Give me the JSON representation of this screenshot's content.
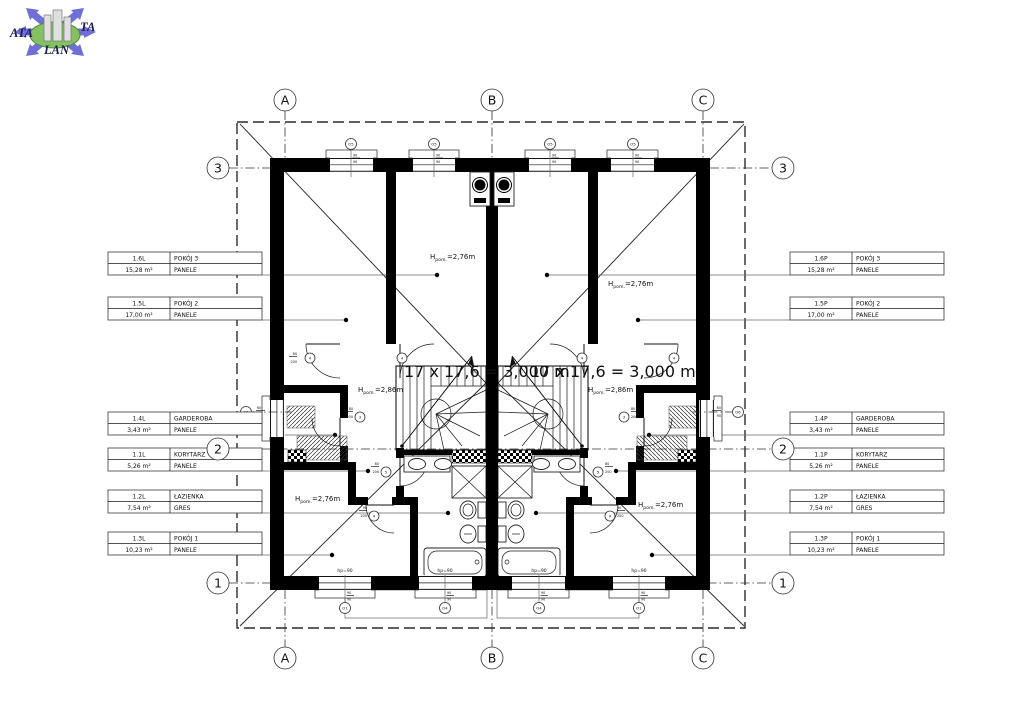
{
  "logo": {
    "ata": "ATA",
    "ta": "TA",
    "lan": "LAN"
  },
  "grid": {
    "cols": [
      "A",
      "B",
      "C"
    ],
    "rows": [
      "3",
      "2",
      "1"
    ]
  },
  "rooms_left": [
    {
      "id": "1.6L",
      "name": "POKÓJ 3",
      "area": "15,28 m²",
      "finish": "PANELE"
    },
    {
      "id": "1.5L",
      "name": "POKÓJ 2",
      "area": "17,00 m²",
      "finish": "PANELE"
    },
    {
      "id": "1.4L",
      "name": "GARDEROBA",
      "area": "3,43 m²",
      "finish": "PANELE"
    },
    {
      "id": "1.1L",
      "name": "KORYTARZ",
      "area": "5,26 m²",
      "finish": "PANELE"
    },
    {
      "id": "1.2L",
      "name": "ŁAZIENKA",
      "area": "7,54 m²",
      "finish": "GRES"
    },
    {
      "id": "1.3L",
      "name": "POKÓJ 1",
      "area": "10,23 m²",
      "finish": "PANELE"
    }
  ],
  "rooms_right": [
    {
      "id": "1.6P",
      "name": "POKÓJ 3",
      "area": "15,28 m²",
      "finish": "PANELE"
    },
    {
      "id": "1.5P",
      "name": "POKÓJ 2",
      "area": "17,00 m²",
      "finish": "PANELE"
    },
    {
      "id": "1.4P",
      "name": "GARDEROBA",
      "area": "3,43 m²",
      "finish": "PANELE"
    },
    {
      "id": "1.1P",
      "name": "KORYTARZ",
      "area": "5,26 m²",
      "finish": "PANELE"
    },
    {
      "id": "1.2P",
      "name": "ŁAZIENKA",
      "area": "7,54 m²",
      "finish": "GRES"
    },
    {
      "id": "1.3P",
      "name": "POKÓJ 1",
      "area": "10,23 m²",
      "finish": "PANELE"
    }
  ],
  "heights": {
    "sym": "H",
    "sub": "pom.",
    "h276": "=2,76m",
    "h286": "=2,86m"
  },
  "stairs": {
    "note": "17 x 17,6 = 3,000 m"
  },
  "openings": {
    "sill_note": "hp=90",
    "top_marker": "O5",
    "top_w": "90",
    "top_h": "90",
    "bottom_marker_room": "O1",
    "bottom_marker_bath": "O4",
    "bottom_w": "90",
    "bottom_h": "90",
    "side_marker": "O6",
    "side_w": "60",
    "side_h": "90",
    "door_marker_hall": "4",
    "door_marker_gard": "3",
    "door_marker_bath": "5",
    "door_marker_room1": "4",
    "door_w": "80",
    "door_w2": "90",
    "door_h": "200"
  }
}
